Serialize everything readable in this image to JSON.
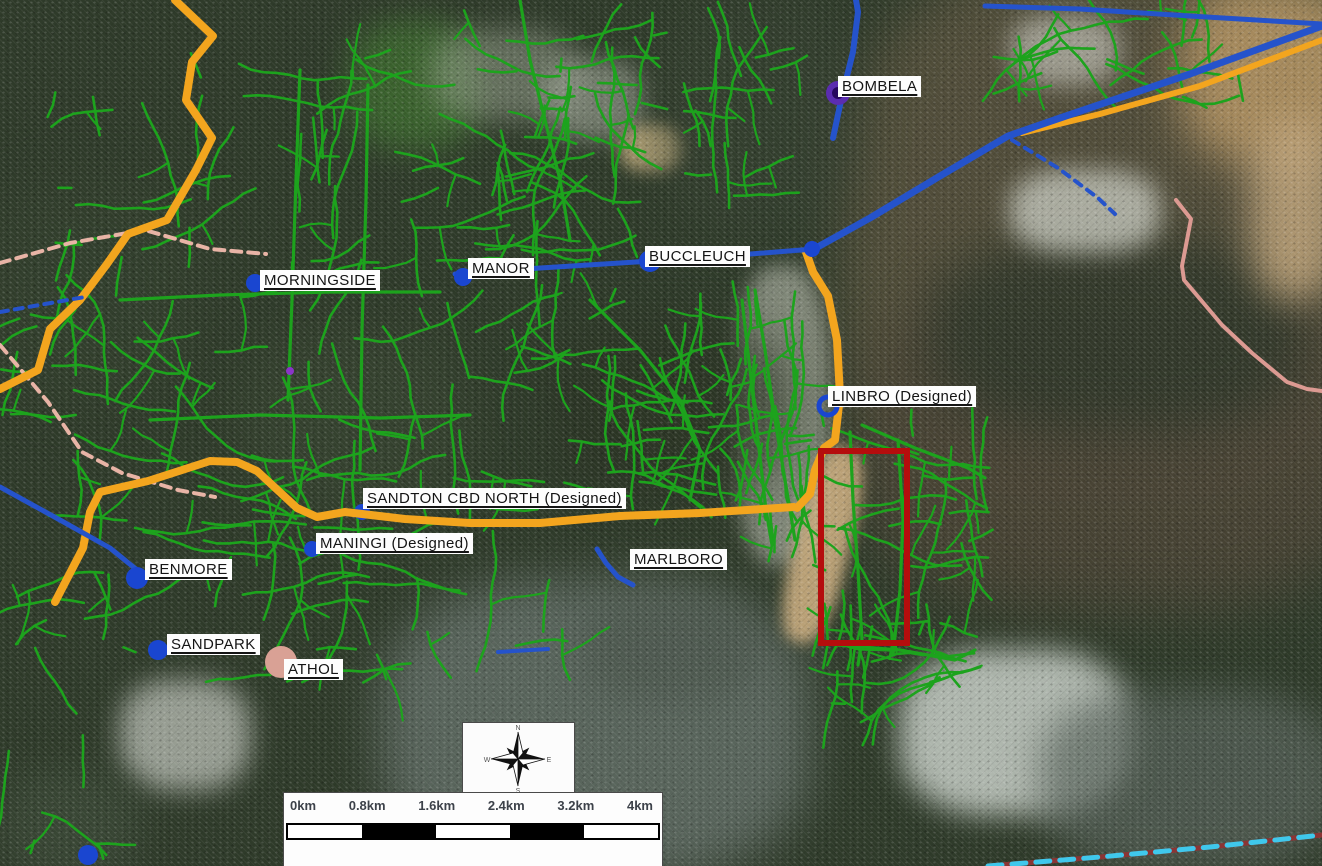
{
  "map": {
    "labels": [
      {
        "text": "BOMBELA",
        "x": 838,
        "y": 76
      },
      {
        "text": "MORNINGSIDE",
        "x": 260,
        "y": 270
      },
      {
        "text": "MANOR",
        "x": 468,
        "y": 258
      },
      {
        "text": "BUCCLEUCH",
        "x": 645,
        "y": 246
      },
      {
        "text": "LINBRO (Designed)",
        "x": 828,
        "y": 386
      },
      {
        "text": "SANDTON CBD NORTH (Designed)",
        "x": 363,
        "y": 488
      },
      {
        "text": "MANINGI (Designed)",
        "x": 316,
        "y": 533
      },
      {
        "text": "MARLBORO",
        "x": 630,
        "y": 549
      },
      {
        "text": "BENMORE",
        "x": 145,
        "y": 559
      },
      {
        "text": "SANDPARK",
        "x": 167,
        "y": 634
      },
      {
        "text": "ATHOL",
        "x": 284,
        "y": 659
      }
    ],
    "scale_bar": {
      "ticks": [
        "0km",
        "0.8km",
        "1.6km",
        "2.4km",
        "3.2km",
        "4km"
      ]
    },
    "compass": {
      "directions": [
        "N",
        "E",
        "S",
        "W"
      ]
    },
    "highlight_box": {
      "x": 818,
      "y": 448,
      "w": 80,
      "h": 186
    },
    "colors": {
      "network_green": "#1da31d",
      "route_orange": "#f3a51e",
      "route_blue": "#2553cb",
      "route_pink": "#dc9a92",
      "dashed_pink": "#e8b4a6",
      "dashed_cyan": "#3fc8ec",
      "dashed_base_red": "#8a3535",
      "highlight_red": "#b50d0d",
      "substation_blue": "#1a46d0",
      "substation_purple": "#5b2db0",
      "substation_purple_core": "#26085e",
      "athol_pink": "#d9a195"
    }
  }
}
